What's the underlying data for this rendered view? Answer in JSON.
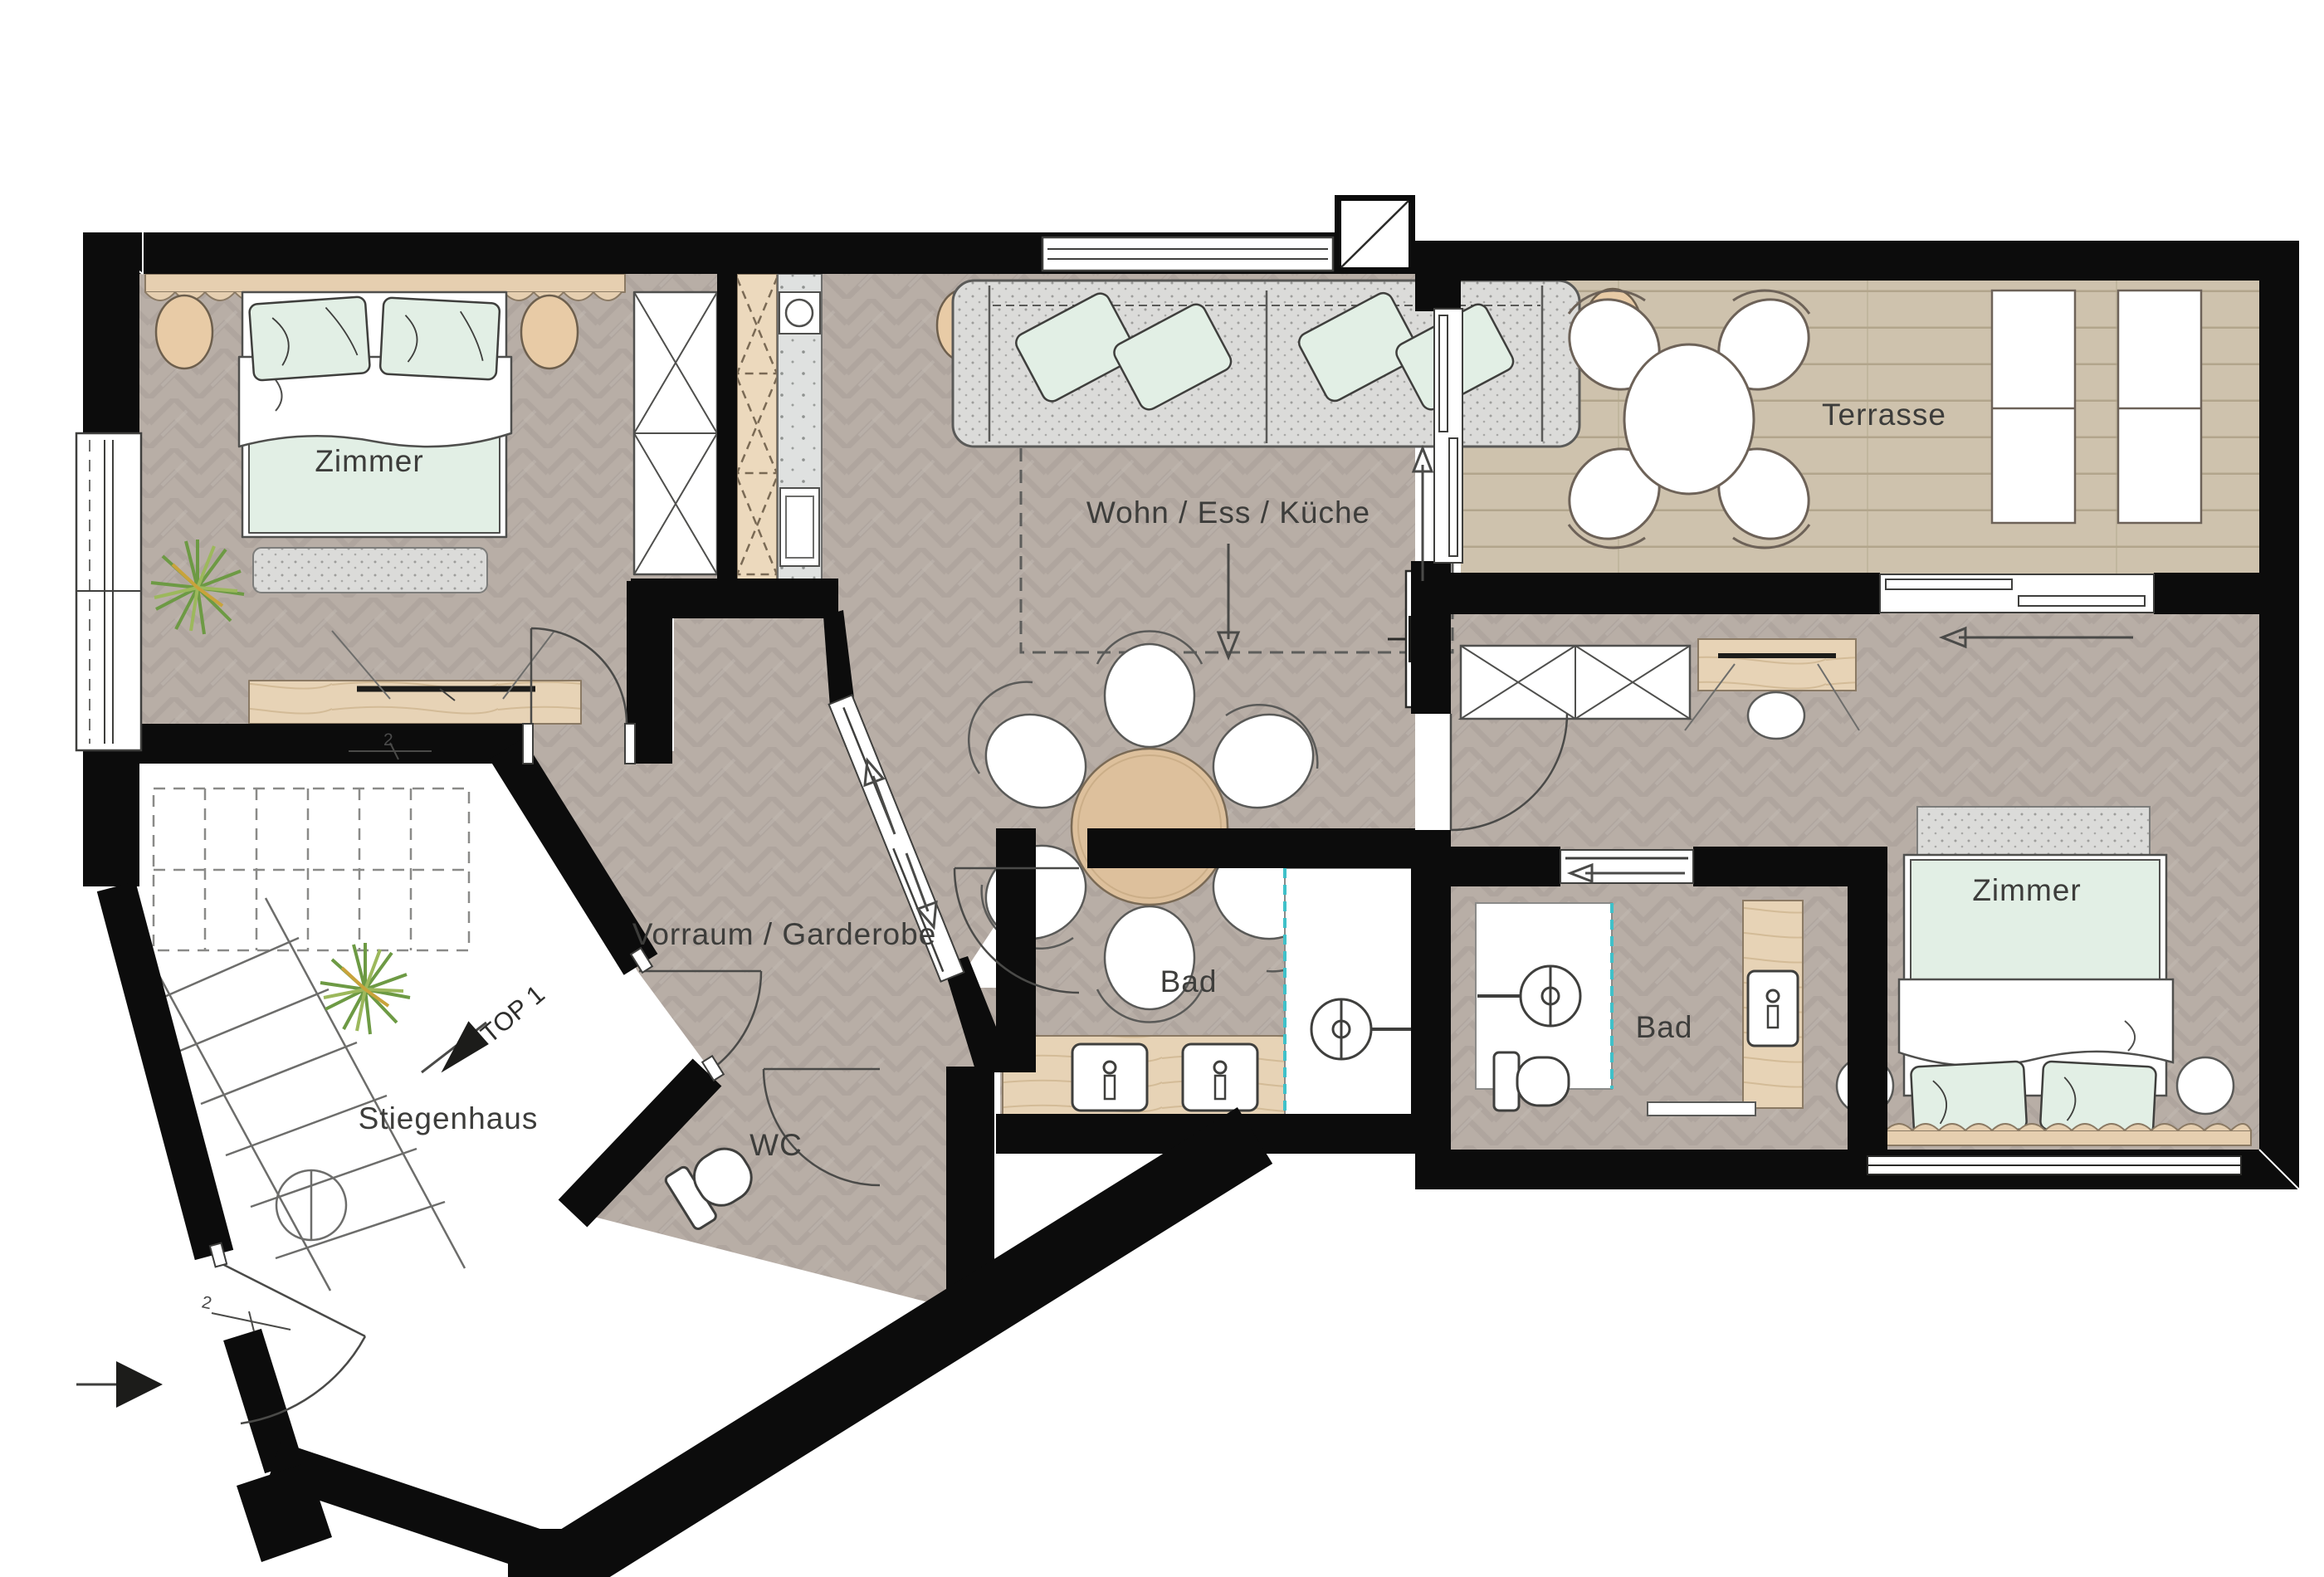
{
  "fp": {
    "labels": {
      "zimmer_left": "Zimmer",
      "zimmer_right": "Zimmer",
      "wohn": "Wohn / Ess / Küche",
      "terrasse": "Terrasse",
      "vorraum": "Vorraum / Garderobe",
      "bad_mitte": "Bad",
      "bad_rechts": "Bad",
      "wc": "WC",
      "stiegenhaus": "Stiegenhaus",
      "top_unit": "TOP 1",
      "door_mark_entry": "2",
      "door_mark_zimmer": "2"
    },
    "colors": {
      "wall": "#0c0c0c",
      "parquet": "#b8aea6",
      "parquet_line": "#a69c94",
      "terrace_deck": "#cec2ad",
      "terrace_line": "#b2a58c",
      "wood": "#e2cba9",
      "counter_gray": "#dfe1e0",
      "mint": "#e2efe5",
      "sofa_gray": "#dbdbd9",
      "tan": "#e8cba6",
      "teal_accent": "#3fc1c9",
      "outline": "#4f4f4d"
    }
  }
}
